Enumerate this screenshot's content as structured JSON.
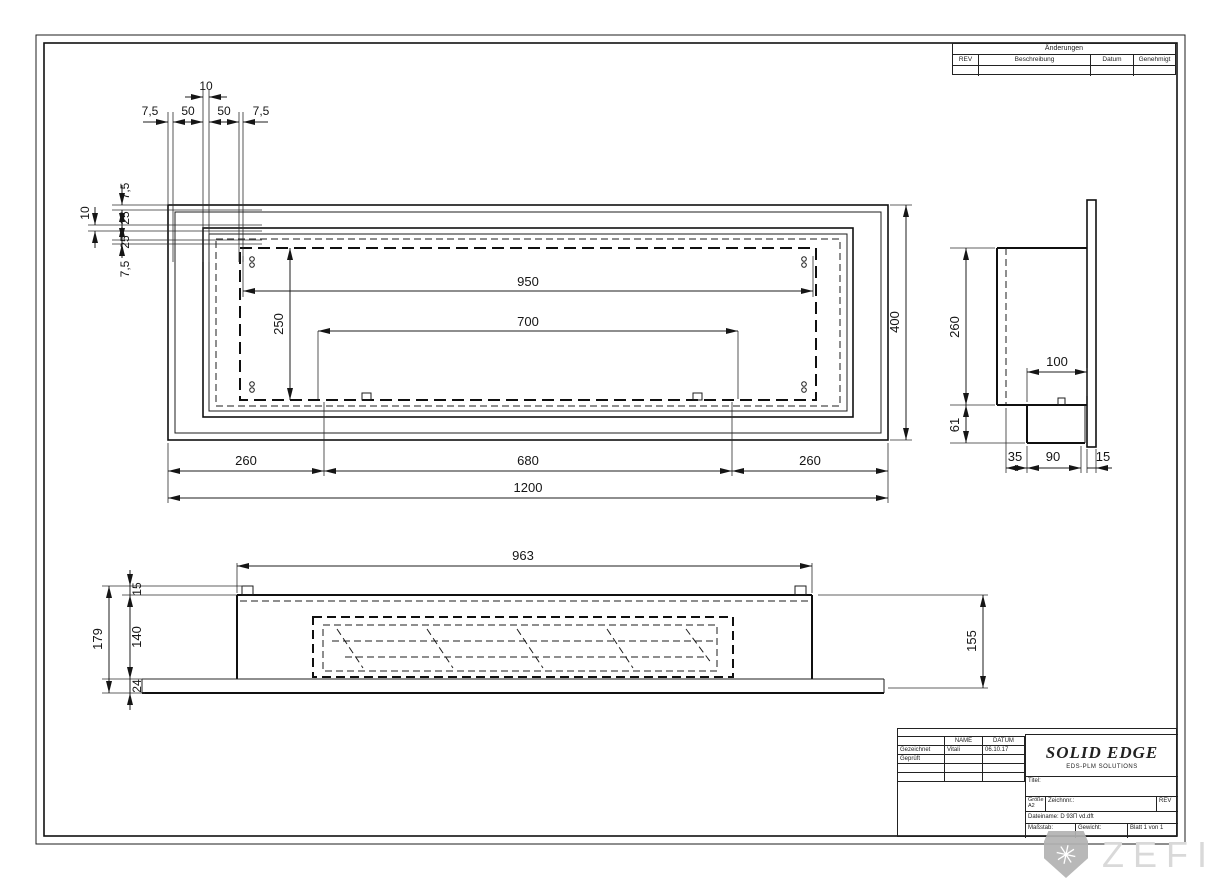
{
  "revision_table": {
    "title": "Änderungen",
    "col_rev": "REV",
    "col_desc": "Beschreibung",
    "col_date": "Datum",
    "col_appr": "Genehmigt"
  },
  "title_block": {
    "col_name": "NAME",
    "col_date": "DATUM",
    "drawn_label": "Gezeichnet",
    "drawn_name": "Vitali",
    "drawn_date": "06.10.17",
    "checked_label": "Geprüft",
    "brand": "SOLID EDGE",
    "brand_sub": "EDS-PLM SOLUTIONS",
    "title_label": "Titel:",
    "size_label": "Größe",
    "size_value": "A2",
    "docno_label": "Zeichnnr.:",
    "rev_label": "REV",
    "filename": "Dateiname: D 93П vd.dft",
    "scale_label": "Maßstab:",
    "weight_label": "Gewicht:",
    "sheet_label": "Blatt 1 von 1"
  },
  "watermark": {
    "text": "ZEFIRE",
    "icon_glyph": "✳"
  },
  "dims": {
    "front": {
      "gap_top": "10",
      "top": [
        "7,5",
        "50",
        "50",
        "7,5"
      ],
      "left": [
        "7,5",
        "25",
        "25",
        "7,5"
      ],
      "gap_left": "10",
      "opening_width": "950",
      "burner_width": "700",
      "opening_height": "250",
      "height": "400",
      "margin_left": "260",
      "center": "680",
      "margin_right": "260",
      "width": "1200"
    },
    "side": {
      "depth": "260",
      "lower": "61",
      "inset": "100",
      "b35": "35",
      "b90": "90",
      "b15": "15"
    },
    "bottom": {
      "width": "963",
      "right": "155",
      "lip": "15",
      "body": "140",
      "base": "24",
      "total": "179"
    }
  }
}
